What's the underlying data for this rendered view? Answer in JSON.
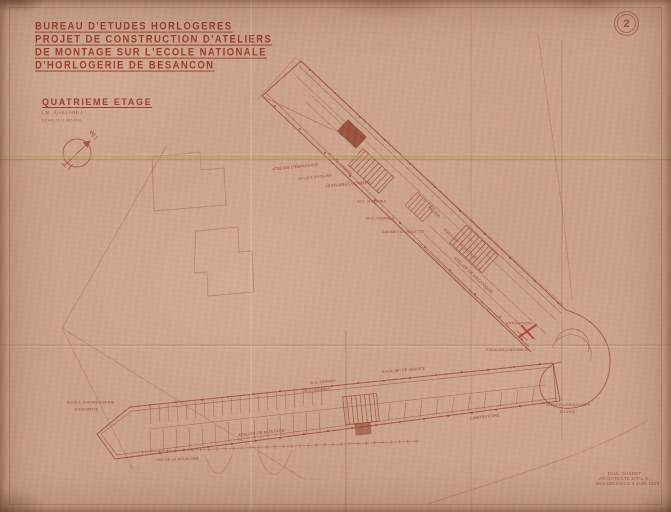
{
  "document": {
    "header": {
      "line1": "BUREAU D'ETUDES HORLOGERES",
      "line2": "PROJET DE CONSTRUCTION D'ATELIERS",
      "line3": "DE MONTAGE SUR L'ECOLE NATIONALE",
      "line4": "D'HORLOGERIE DE BESANCON"
    },
    "floor": {
      "title": "QUATRIEME ETAGE",
      "subtitle": "( M. JUAILLARD )",
      "scale": "ECHELLE 0.005 P.M."
    },
    "stamp_number": "2",
    "compass_label": "N",
    "signature": {
      "line1": "PAUL GUADET",
      "line2": "ARCHITECTE D.P.L.G.",
      "line3": "BESANCON LE 4 JUIN 1929"
    }
  },
  "plan_labels": [
    {
      "text": "ATELIER D'EBAUCHES"
    },
    {
      "text": "A PLACE D'ATELIER"
    },
    {
      "text": "VESTIAIRES HOMMES"
    },
    {
      "text": "MONTE-CHARGE"
    },
    {
      "text": "W.C. HOMMES"
    },
    {
      "text": "W.C. FEMMES"
    },
    {
      "text": "CABINET DE TOILETTE"
    },
    {
      "text": "PALIER"
    },
    {
      "text": "ESCALIER DE SECOURS"
    },
    {
      "text": "ATELIER DE MECANIQUE"
    },
    {
      "text": "EXPOSITION"
    },
    {
      "text": "ESCALIER D'HONNEUR"
    },
    {
      "text": "ESCALIER DE SERVICE"
    },
    {
      "text": "W.C. FEMMES"
    },
    {
      "text": "W.C. HOMMES"
    },
    {
      "text": "ATELIER DE MONTAGE"
    },
    {
      "text": "ECOLE D'HORLOGERIE"
    },
    {
      "text": "EXISTANTE"
    },
    {
      "text": "ATELIER A PROLONGER"
    },
    {
      "text": "EN 1950"
    },
    {
      "text": "LABORATOIRE"
    },
    {
      "text": "RUE DE LA MOUILLERE"
    }
  ],
  "colors": {
    "paper": "#c9a18a",
    "ink": "#96442f",
    "ink_faint": "#a9705a",
    "title_ink": "#9c3b2a",
    "fold": "#b7a45c",
    "pencil_red": "#b5342a"
  }
}
